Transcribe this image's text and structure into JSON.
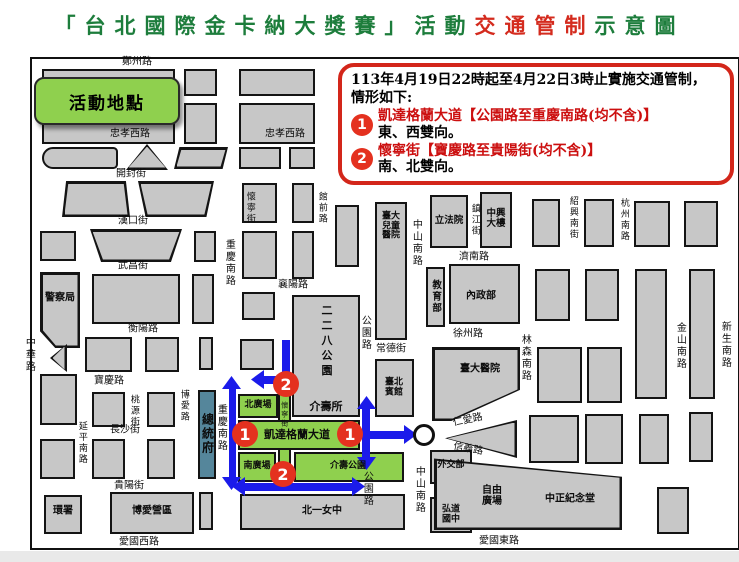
{
  "title": {
    "prefix": "「台北國際金卡納大獎賽」活動",
    "highlight": "交通管制",
    "suffix": "示意圖"
  },
  "legend": {
    "label": "活動地點"
  },
  "notice": {
    "line1": "113年4月19日22時起至4月22日3時止實施交通管制，",
    "line2": "情形如下:",
    "items": [
      {
        "num": "1",
        "road": "凱達格蘭大道【公園路至重慶南路(均不含)】",
        "detail": "東、西雙向。"
      },
      {
        "num": "2",
        "road": "懷寧街【寶慶路至貴陽街(均不含)】",
        "detail": "南、北雙向。"
      }
    ]
  },
  "colors": {
    "title_green": "#1d7d3c",
    "title_red": "#d42b1e",
    "notice_border": "#d3261a",
    "notice_red": "#cc0f0f",
    "block_gray": "#c7c7c7",
    "plaza_green": "#8fd04e",
    "presidential_teal": "#55869b",
    "arrow_blue": "#1b1bea",
    "badge_red": "#e4311f"
  },
  "map": {
    "road_labels": [
      {
        "text": "鄭州路",
        "cx": 105,
        "cy": 4
      },
      {
        "text": "忠孝西路",
        "cx": 98,
        "cy": 76
      },
      {
        "text": "忠孝西路",
        "cx": 253,
        "cy": 76
      },
      {
        "text": "開封街",
        "cx": 99,
        "cy": 116
      },
      {
        "text": "漢口街",
        "cx": 101,
        "cy": 163
      },
      {
        "text": "武昌街",
        "cx": 101,
        "cy": 208
      },
      {
        "text": "衡陽路",
        "cx": 111,
        "cy": 271
      },
      {
        "text": "寶慶路",
        "cx": 77,
        "cy": 323
      },
      {
        "text": "長沙街",
        "cx": 93,
        "cy": 372
      },
      {
        "text": "貴陽街",
        "cx": 97,
        "cy": 428
      },
      {
        "text": "愛國西路",
        "cx": 107,
        "cy": 484
      },
      {
        "text": "襄陽路",
        "cx": 261,
        "cy": 227
      },
      {
        "text": "常德街",
        "cx": 359,
        "cy": 291
      },
      {
        "text": "徐州路",
        "cx": 436,
        "cy": 276
      },
      {
        "text": "濟南路",
        "cx": 442,
        "cy": 199
      },
      {
        "text": "愛國東路",
        "cx": 467,
        "cy": 483
      },
      {
        "text": "仁愛路",
        "cx": 436,
        "cy": 362,
        "rot": -12
      },
      {
        "text": "信義路",
        "cx": 436,
        "cy": 391,
        "rot": 10
      },
      {
        "text": "凱達格蘭大道",
        "cx": 265,
        "cy": 376,
        "bold": true,
        "size": 11
      },
      {
        "text": "中華路",
        "cx": -4,
        "cy": 296,
        "v": true
      },
      {
        "text": "重慶南路",
        "cx": 196,
        "cy": 204,
        "v": true
      },
      {
        "text": "重慶南路",
        "cx": 188,
        "cy": 369,
        "v": true
      },
      {
        "text": "懷寧街",
        "cx": 217,
        "cy": 149,
        "v": true,
        "size": 9
      },
      {
        "text": "館前路",
        "cx": 289,
        "cy": 149,
        "v": true,
        "size": 9
      },
      {
        "text": "桃源街",
        "cx": 101,
        "cy": 352,
        "v": true,
        "size": 9
      },
      {
        "text": "博愛路",
        "cx": 151,
        "cy": 347,
        "v": true,
        "size": 9
      },
      {
        "text": "延平南路",
        "cx": 49,
        "cy": 384,
        "v": true,
        "size": 9
      },
      {
        "text": "公園路",
        "cx": 332,
        "cy": 274,
        "v": true
      },
      {
        "text": "公園路",
        "cx": 334,
        "cy": 430,
        "v": true
      },
      {
        "text": "中山南路",
        "cx": 383,
        "cy": 184,
        "v": true
      },
      {
        "text": "中山南路",
        "cx": 386,
        "cy": 431,
        "v": true
      },
      {
        "text": "林森南路",
        "cx": 492,
        "cy": 299,
        "v": true
      },
      {
        "text": "金山南路",
        "cx": 647,
        "cy": 287,
        "v": true
      },
      {
        "text": "新生南路",
        "cx": 692,
        "cy": 286,
        "v": true
      },
      {
        "text": "杭州南路",
        "cx": 591,
        "cy": 161,
        "v": true,
        "size": 9
      },
      {
        "text": "紹興南街",
        "cx": 540,
        "cy": 159,
        "v": true,
        "size": 9
      },
      {
        "text": "鎮江街",
        "cx": 442,
        "cy": 161,
        "v": true,
        "size": 9
      },
      {
        "text": "懷寧街",
        "cx": 252,
        "cy": 356,
        "v": true,
        "size": 7
      }
    ],
    "building_labels": [
      {
        "text": "警察局",
        "cx": 28,
        "cy": 240
      },
      {
        "text": "總統府",
        "cx": 175,
        "cy": 375,
        "v": true,
        "size": 12
      },
      {
        "text": "北廣場",
        "cx": 226,
        "cy": 347,
        "size": 9
      },
      {
        "text": "南廣場",
        "cx": 225,
        "cy": 408,
        "size": 9
      },
      {
        "text": "介壽公園",
        "cx": 316,
        "cy": 408,
        "size": 9
      },
      {
        "text": "介壽所",
        "cx": 294,
        "cy": 348,
        "size": 11
      },
      {
        "text": "二二八公園",
        "cx": 294,
        "cy": 283,
        "v": true,
        "size": 11,
        "spacing": 4
      },
      {
        "text": "北一女中",
        "cx": 290,
        "cy": 453
      },
      {
        "text": "外交部",
        "cx": 419,
        "cy": 407,
        "size": 9
      },
      {
        "text": "弘道國中",
        "cx": 419,
        "cy": 456,
        "size": 9,
        "w": 26
      },
      {
        "text": "臺北賓館",
        "cx": 362,
        "cy": 329,
        "size": 9,
        "w": 26
      },
      {
        "text": "臺大醫院",
        "cx": 448,
        "cy": 311
      },
      {
        "text": "臺大兒童醫院",
        "cx": 359,
        "cy": 168,
        "size": 9,
        "w": 24
      },
      {
        "text": "立法院",
        "cx": 417,
        "cy": 162,
        "size": 9.5
      },
      {
        "text": "中興大樓",
        "cx": 464,
        "cy": 160,
        "size": 9.5,
        "w": 26
      },
      {
        "text": "內政部",
        "cx": 449,
        "cy": 238
      },
      {
        "text": "教育部",
        "cx": 403,
        "cy": 238,
        "v": true,
        "size": 9.5
      },
      {
        "text": "環署",
        "cx": 31,
        "cy": 453
      },
      {
        "text": "博愛營區",
        "cx": 120,
        "cy": 453
      },
      {
        "text": "自由廣場",
        "cx": 460,
        "cy": 438,
        "w": 26
      },
      {
        "text": "中正紀念堂",
        "cx": 538,
        "cy": 441
      }
    ],
    "badges": [
      {
        "num": "1",
        "cx": 213,
        "cy": 375
      },
      {
        "num": "1",
        "cx": 318,
        "cy": 375
      },
      {
        "num": "2",
        "cx": 254,
        "cy": 325
      },
      {
        "num": "2",
        "cx": 251,
        "cy": 415
      }
    ]
  }
}
